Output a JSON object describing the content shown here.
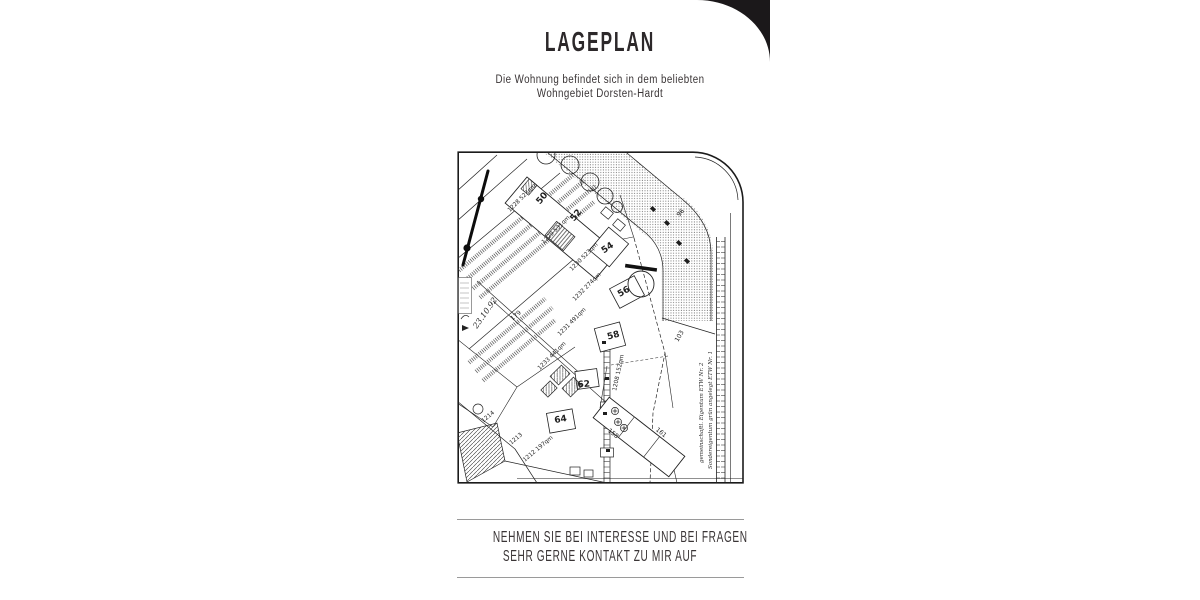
{
  "page": {
    "title": "LAGEPLAN",
    "subtitle": {
      "line1": "Die Wohnung befindet sich in dem beliebten",
      "line2": "Wohngebiet Dorsten-Hardt"
    },
    "footer": {
      "line1": "NEHMEN SIE BEI INTERESSE UND BEI FRAGEN",
      "line2": "SEHR GERNE KONTAKT ZU MIR AUF"
    }
  },
  "map": {
    "description": "scanned cadastral site plan (Lageplan)",
    "house_numbers": [
      "50",
      "52",
      "54",
      "56",
      "58",
      "62",
      "64"
    ],
    "parcel_labels": [
      "1228 523qm",
      "1229 531qm",
      "1230 523qm",
      "1232 274qm",
      "1231 491qm",
      "1233 441qm",
      "1214",
      "1213",
      "1212 197qm",
      "1208 152qm"
    ],
    "street_numbers": [
      "179",
      "96",
      "103",
      "161",
      "158"
    ],
    "notes": {
      "date": "23.10.92",
      "right_margin_1": "gemeinschaftl. Eigentum ETW Nr. 2",
      "right_margin_2": "Sondereigentum grün angelegt ETW Nr. 1"
    }
  },
  "colors": {
    "ink_strong": "#2c282a",
    "ink": "#3a3536",
    "rule": "#9a9a9a",
    "corner": "#1b181a",
    "map_ink": "#1f1f1f"
  }
}
